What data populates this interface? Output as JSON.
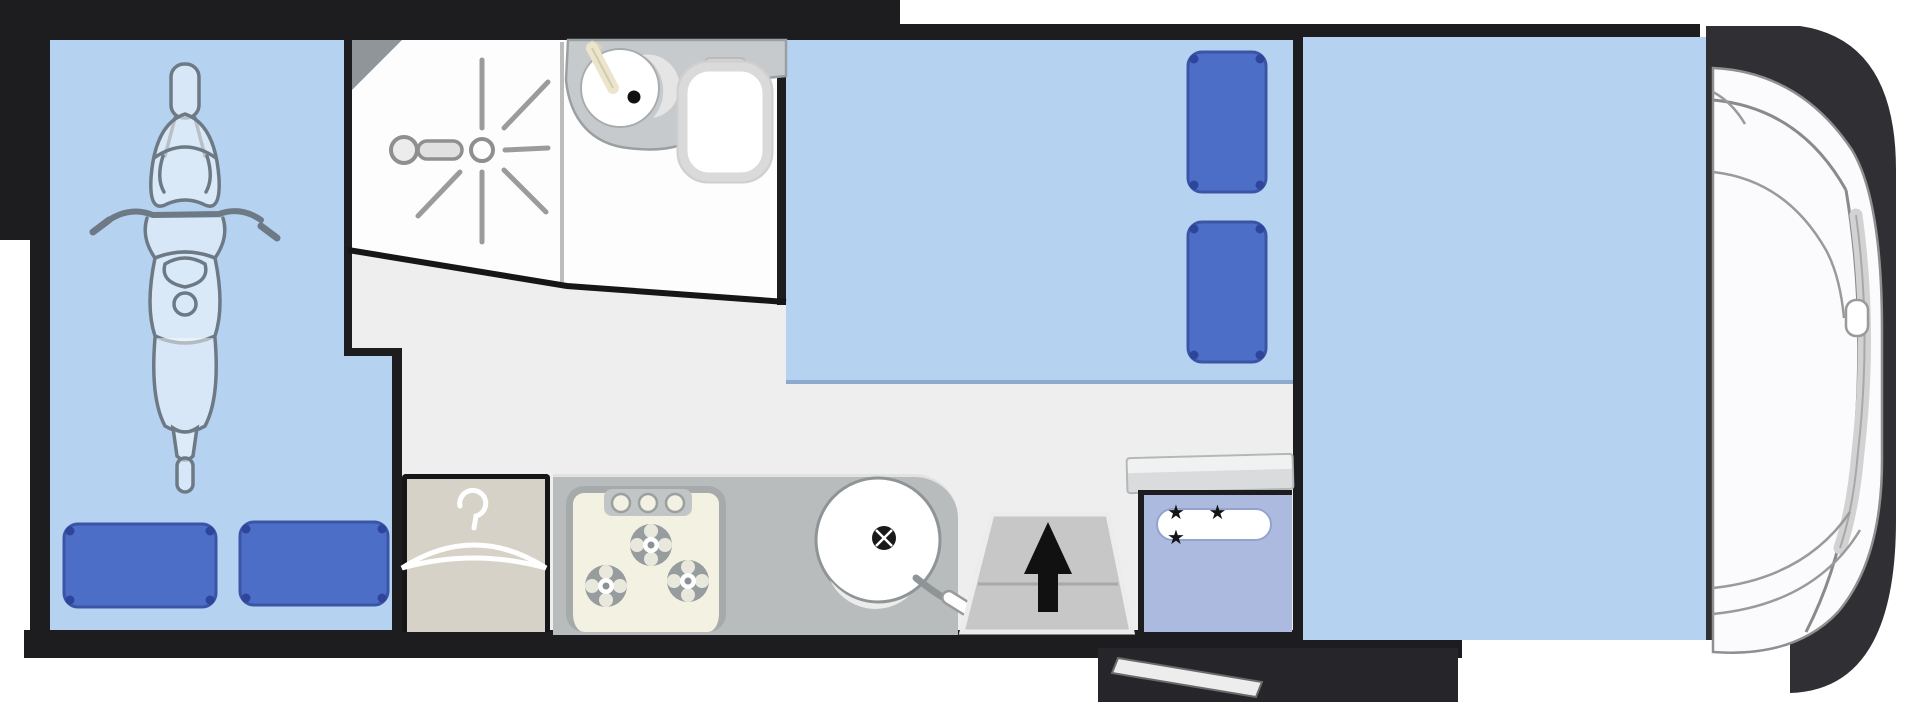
{
  "diagram": {
    "type": "motorhome-floor-plan-top-view",
    "orientation": "cab-on-right",
    "rooms": {
      "garage": {
        "label": "Rear garage",
        "contents": [
          "scooter-top-view",
          "two-pillows"
        ],
        "pillow_count": 2
      },
      "bathroom": {
        "label": "Bathroom",
        "features": [
          "shower",
          "washbasin",
          "toilet"
        ]
      },
      "bed": {
        "label": "Rear double bed",
        "pillow_count": 2
      },
      "kitchen": {
        "label": "Kitchen block",
        "burner_count": 3,
        "features": [
          "three-burner-hob",
          "round-sink",
          "faucet"
        ]
      },
      "wardrobe": {
        "label": "Wardrobe",
        "icon": "hanger-icon"
      },
      "entry": {
        "label": "Entrance step",
        "icon": "arrow-up-icon"
      },
      "fridge": {
        "label": "Fridge",
        "stars": "★ ★ ★"
      },
      "lounge": {
        "label": "Front lounge / drop-down bed area"
      },
      "cab": {
        "label": "Driver cab",
        "features": [
          "windscreen",
          "door-handle",
          "side-window"
        ]
      }
    },
    "colors": {
      "wall": "#1d1d20",
      "room_blue": "#b5d3f0",
      "pillow_blue": "#4d6ec6",
      "floor": "#eeeeef",
      "counter_gray": "#b9bcbc",
      "stove_cream": "#f3f1e2",
      "fridge_blue": "#abbade",
      "wardrobe_beige": "#d6d2c7",
      "cab_shadow": "#303034"
    }
  }
}
